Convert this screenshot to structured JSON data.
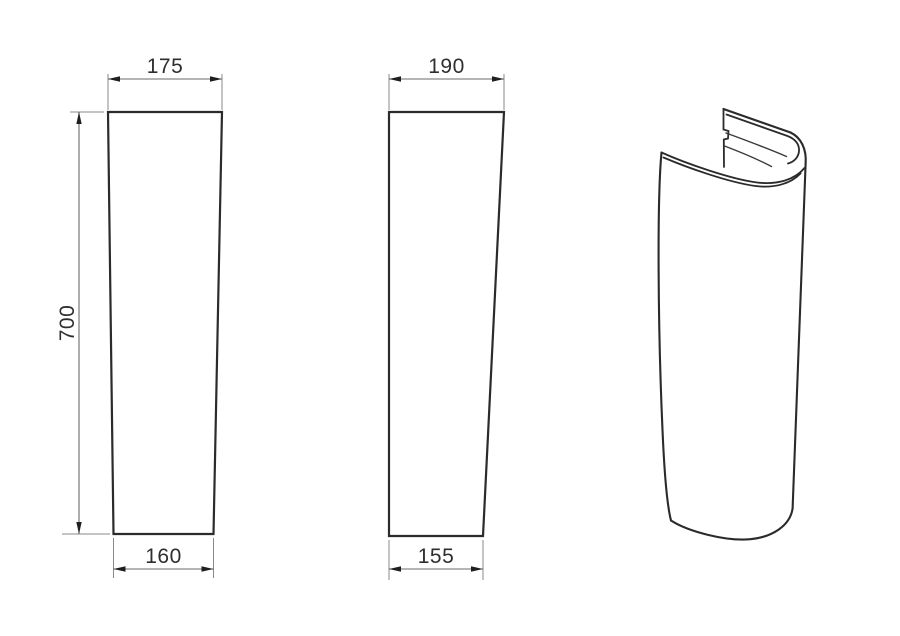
{
  "drawing": {
    "type": "technical-dimension-drawing",
    "subject": "washbasin-pedestal",
    "background": "#ffffff",
    "colors": {
      "outline": "#2b2b2b",
      "dimension_lines": "#6a6a6a",
      "arrows": "#1f1f1f",
      "text": "#2e2e2e"
    },
    "views": {
      "front": {
        "label": "front-view",
        "width_top": "175",
        "height": "700",
        "width_bottom": "160"
      },
      "side": {
        "label": "side-view",
        "depth_top": "190",
        "depth_bottom": "155"
      },
      "perspective": {
        "label": "perspective-view"
      }
    }
  }
}
